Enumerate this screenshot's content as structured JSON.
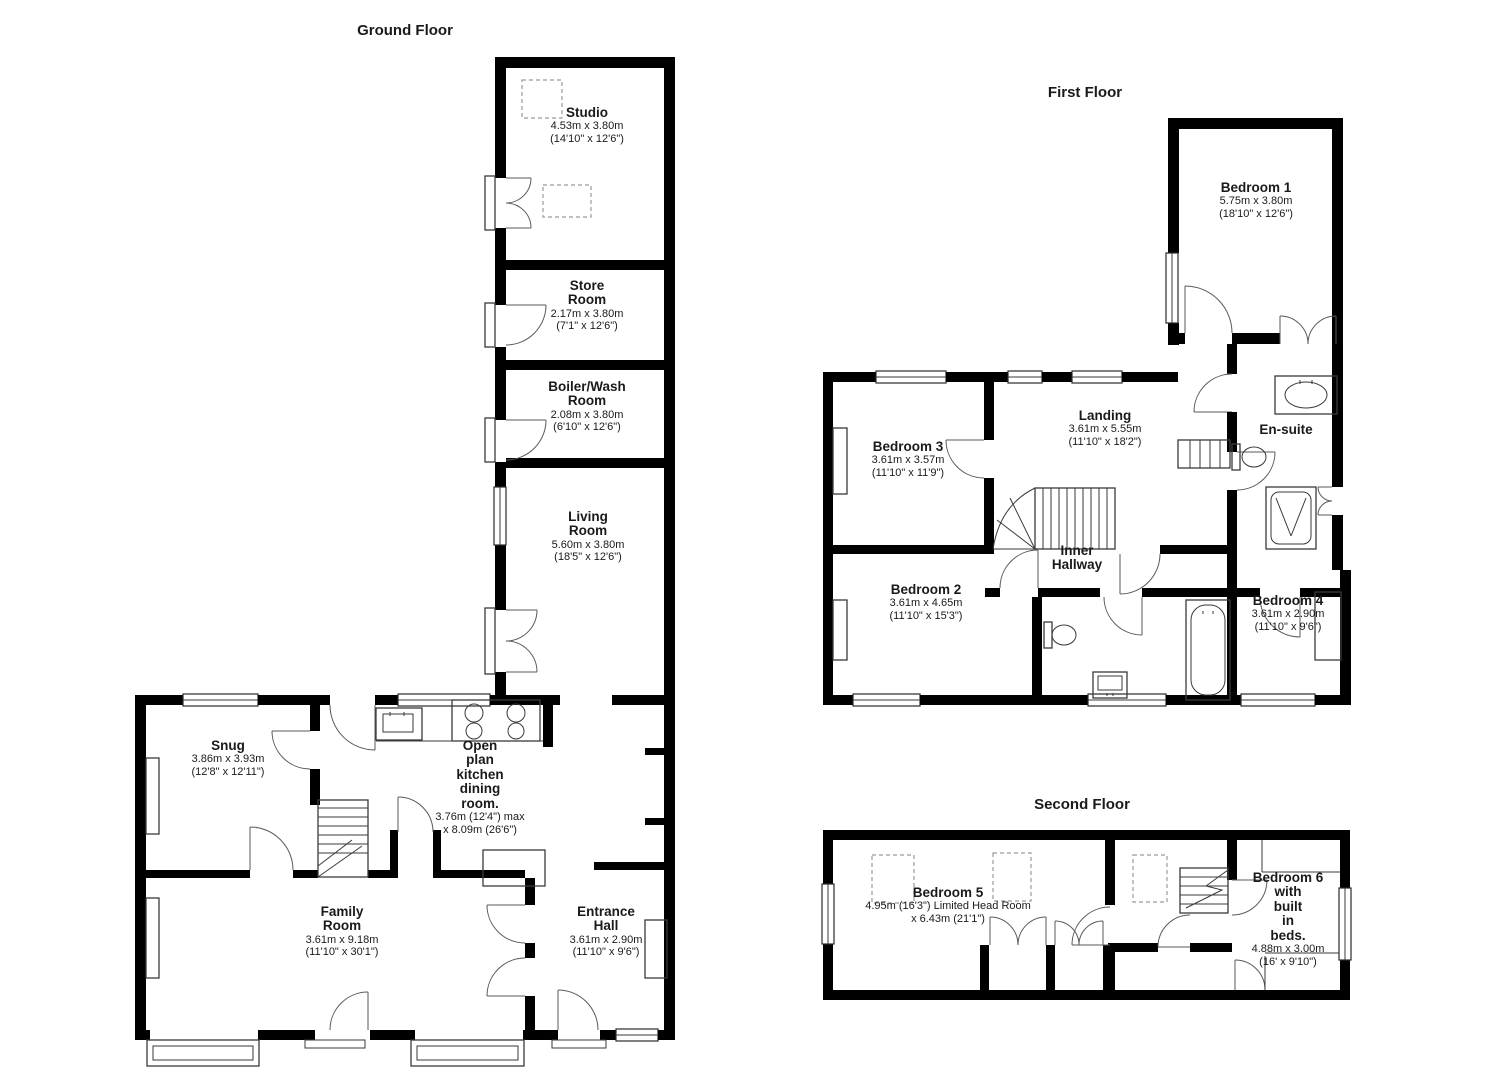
{
  "floors": {
    "ground": {
      "title": "Ground Floor",
      "rooms": {
        "studio": {
          "name": "Studio",
          "dims": "4.53m x 3.80m\n(14'10\" x 12'6\")"
        },
        "store": {
          "name": "Store\nRoom",
          "dims": "2.17m x 3.80m\n(7'1\" x 12'6\")"
        },
        "boiler": {
          "name": "Boiler/Wash\nRoom",
          "dims": "2.08m x 3.80m\n(6'10\" x 12'6\")"
        },
        "living": {
          "name": "Living\nRoom",
          "dims": "5.60m x 3.80m\n(18'5\" x 12'6\")"
        },
        "snug": {
          "name": "Snug",
          "dims": "3.86m x 3.93m\n(12'8\" x 12'11\")"
        },
        "kitchen": {
          "name": "Open\nplan\nkitchen\ndining\nroom.",
          "dims": "3.76m (12'4\") max\nx 8.09m (26'6\")"
        },
        "family": {
          "name": "Family\nRoom",
          "dims": "3.61m x 9.18m\n(11'10\" x 30'1\")"
        },
        "entrance": {
          "name": "Entrance\nHall",
          "dims": "3.61m x 2.90m\n(11'10\" x 9'6\")"
        }
      }
    },
    "first": {
      "title": "First Floor",
      "rooms": {
        "bedroom1": {
          "name": "Bedroom 1",
          "dims": "5.75m x 3.80m\n(18'10\" x 12'6\")"
        },
        "bedroom3": {
          "name": "Bedroom 3",
          "dims": "3.61m x 3.57m\n(11'10\" x 11'9\")"
        },
        "landing": {
          "name": "Landing",
          "dims": "3.61m x 5.55m\n(11'10\" x 18'2\")"
        },
        "ensuite": {
          "name": "En-suite",
          "dims": ""
        },
        "innerhallway": {
          "name": "Inner\nHallway",
          "dims": ""
        },
        "bedroom2": {
          "name": "Bedroom 2",
          "dims": "3.61m x 4.65m\n(11'10\" x 15'3\")"
        },
        "bedroom4": {
          "name": "Bedroom 4",
          "dims": "3.61m x 2.90m\n(11'10\" x 9'6\")"
        }
      }
    },
    "second": {
      "title": "Second Floor",
      "rooms": {
        "bedroom5": {
          "name": "Bedroom 5",
          "dims": "4.95m (16'3\") Limited Head Room\nx 6.43m (21'1\")"
        },
        "bedroom6": {
          "name": "Bedroom 6\nwith\nbuilt\nin\nbeds.",
          "dims": "4.88m x 3.00m\n(16' x 9'10\")"
        }
      }
    }
  }
}
